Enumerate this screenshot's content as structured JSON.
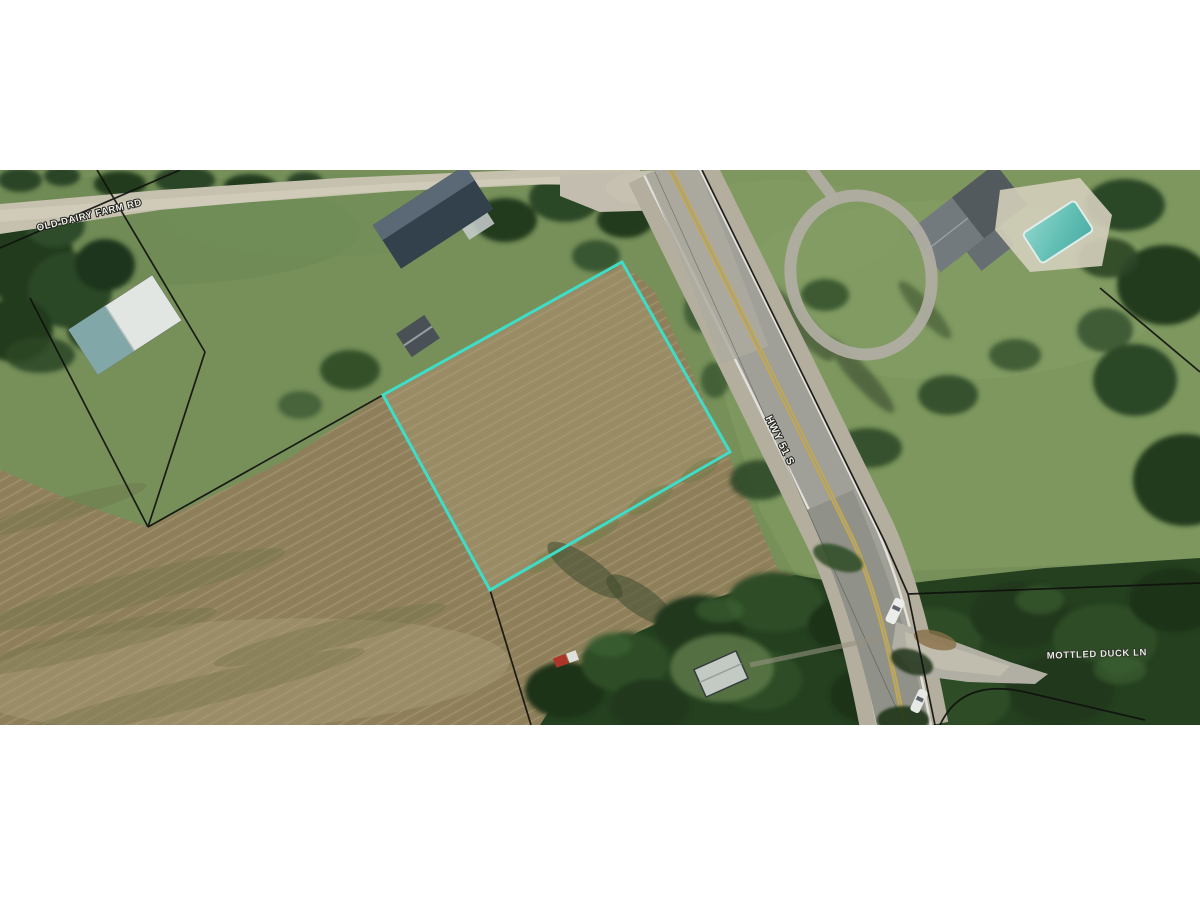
{
  "window": {
    "background": "#ffffff",
    "description_kind": "aerial satellite photo of land parcel listing"
  },
  "aerial_photo": {
    "labels": {
      "dairy_road": "OLD DAIRY FARM RD",
      "highway": "HWY 51 S",
      "duck_lane": "MOTTLED DUCK LN"
    },
    "colors": {
      "parcel_outline": "#3FE3CE",
      "boundary_lines": "#0F0F0D",
      "road_label_text": "#F5F5F0",
      "pool_water": "#6EC9C0",
      "highway_centerline": "#D2AE3C",
      "letterbox": "#FFFFFF"
    }
  }
}
